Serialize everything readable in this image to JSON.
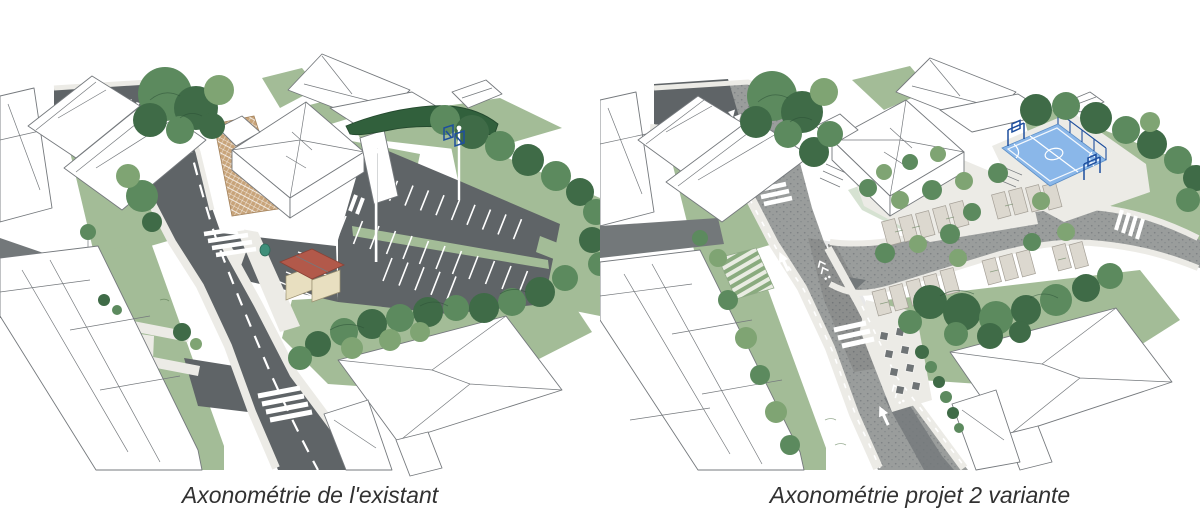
{
  "page": {
    "background": "#ffffff"
  },
  "panels": [
    {
      "id": "existing",
      "caption": "Axonométrie de l'existant",
      "alt": "Hand-drawn axonometric view of the existing site: street with zebra crossings, school building with paved path, large asphalt car park, small red-roof kiosk, surrounding trees and lawns"
    },
    {
      "id": "projet-2-variante",
      "caption": "Axonométrie projet 2 variante",
      "alt": "Hand-drawn axonometric view of project variant 2: redesigned shared street with arrows and bike markings, tree-lined parking bays, school forecourt, blue basketball court and picnic terrace"
    }
  ],
  "palette": {
    "caption_text": "#313131",
    "sketch_line": "#75797d",
    "road_dark": "#5f6467",
    "road_textured": "#9a9d9c",
    "road_side": "#73787a",
    "sidewalk": "#ecebe6",
    "grass": "#a3bc97",
    "grass_dark": "#8aab7f",
    "tree_dark": "#3f6b47",
    "tree_mid": "#5c8a5e",
    "tree_light": "#7fa473",
    "tree_pale": "#a9c498",
    "hedge": "#31603c",
    "path_tan": "#c8a47a",
    "paver": "#dcd8cf",
    "roof_red": "#b2594a",
    "wall_cream": "#e8dfc0",
    "court_blue": "#8ab7e9",
    "court_structure": "#1d4e9e",
    "bin_teal": "#3f8f7a",
    "marking_white": "#ffffff"
  }
}
